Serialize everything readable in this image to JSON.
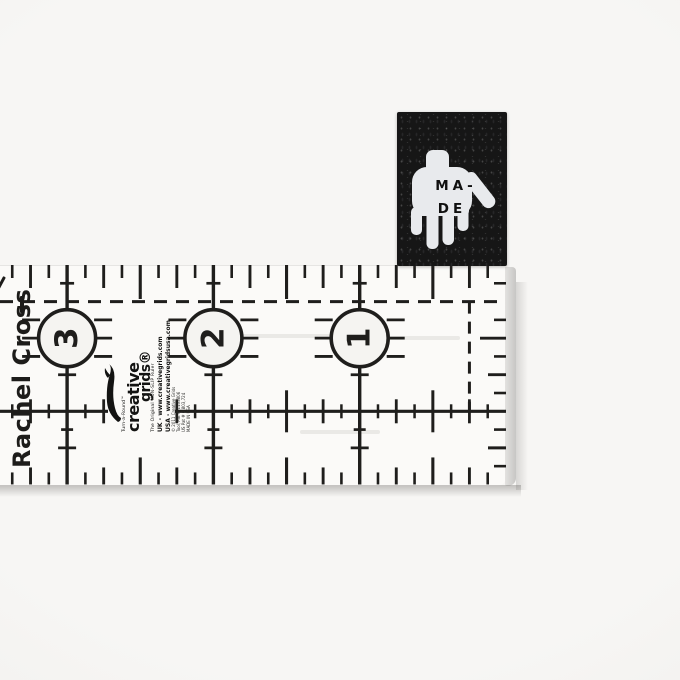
{
  "scene": {
    "background_color": "#f5f4f2"
  },
  "tag": {
    "brand_line1": "MA-",
    "brand_line2": "DE",
    "tag_color": "#161616",
    "hand_color": "#e8eaed"
  },
  "ruler": {
    "owner_label": "Rachel Cross",
    "scale_numbers": [
      "1",
      "2",
      "3"
    ],
    "ink_color": "#1f1e1c",
    "circle_fill": "#f5f4f1",
    "brand": {
      "tagline_top": "Turn-a-Round™",
      "wordmark_line1": "creative",
      "wordmark_line2": "grids®",
      "tagline_bottom": "The Original NON-SLIP Ruler",
      "url_uk": "UK - www.creativegrids.com",
      "url_usa": "USA - www.creativegridsusa.com",
      "copyright": "© 2011 Creative Grids",
      "patent1": "Tool, Pat # 1133806",
      "patent2": "US Pat # 6,803,724",
      "made_in": "MADE IN USA"
    }
  }
}
